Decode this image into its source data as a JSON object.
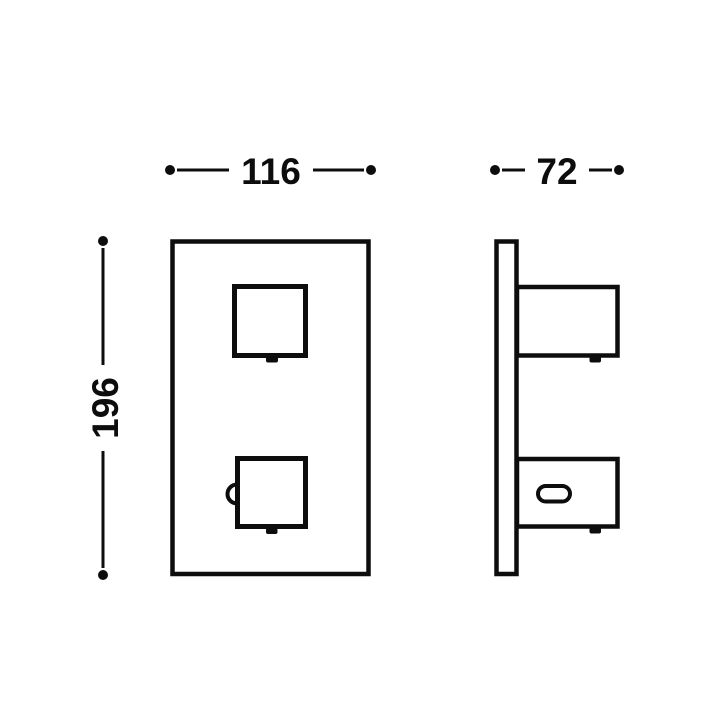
{
  "colors": {
    "line": "#0d0d0d",
    "background": "#ffffff"
  },
  "dimensions": {
    "front_width": "116",
    "side_depth": "72",
    "front_height": "196"
  }
}
